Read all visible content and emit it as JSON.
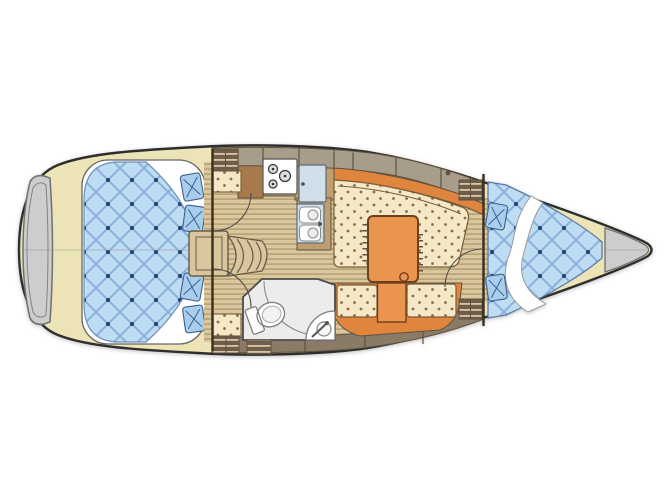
{
  "page": {
    "background": "#ffffff"
  },
  "palette": {
    "pageBg": "#ffffff",
    "hullOutline": "#2e2e2e",
    "hullCream": "#ece4b6",
    "panelGray": "#cdcdcd",
    "panelLine": "#707070",
    "woodLight": "#d9c79d",
    "woodDark": "#b49c72",
    "taupe": "#a89c8b",
    "taupeDark": "#8a7b66",
    "lineBrown": "#5f5240",
    "counterTan": "#bf9e70",
    "cabinetBrown": "#a8794c",
    "orange": "#e0853e",
    "orangeLight": "#e9954f",
    "creamSeat": "#f5e8c6",
    "seatDot": "#8a6d48",
    "quiltBlue": "#bedcf2",
    "quiltLine": "#8ab1dc",
    "quiltDot": "#24426b",
    "pillowBlue": "#a9cdec",
    "pillowLine": "#3c5f8c",
    "applianceBlue": "#cfdfe9",
    "fixtureLine": "#7d7d7d",
    "headFloor": "#ececec",
    "stepWood": "#d8c69e",
    "ventDark": "#6e5e4b",
    "ventLight": "#d9c7a2",
    "centerline": "#9a9a9a",
    "white": "#ffffff"
  },
  "vessel": {
    "view": "top-down-interior-floor-plan",
    "areas": [
      {
        "id": "aft-cabin",
        "label": "aft double-berth cabin"
      },
      {
        "id": "companionway",
        "label": "companionway steps"
      },
      {
        "id": "galley",
        "label": "galley with stove, refrigerator, double sink"
      },
      {
        "id": "saloon",
        "label": "saloon settees with folding table"
      },
      {
        "id": "head",
        "label": "head with toilet and corner basin"
      },
      {
        "id": "fore-cabin",
        "label": "forward V-berth cabin"
      }
    ]
  }
}
